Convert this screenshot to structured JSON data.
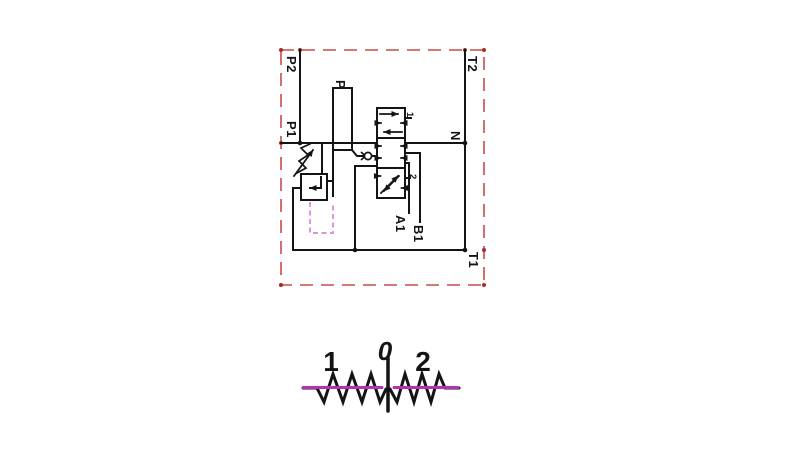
{
  "schematic": {
    "ports": {
      "p2": "P2",
      "t2": "T2",
      "p1": "P1",
      "n": "N",
      "t1": "T1",
      "p": "P",
      "a1": "A1",
      "b1": "B1"
    },
    "spool_positions": {
      "pos1": "1",
      "pos2": "2"
    },
    "colors": {
      "line_black": "#141414",
      "boundary_red": "#c64b4b",
      "boundary_dot_red": "#a82a2a",
      "pilot_magenta": "#d882d8"
    }
  },
  "lever_diagram": {
    "left": "1",
    "center": "0",
    "right": "2",
    "colors": {
      "spring_black": "#141414",
      "highlight_magenta": "#b430b4"
    }
  }
}
